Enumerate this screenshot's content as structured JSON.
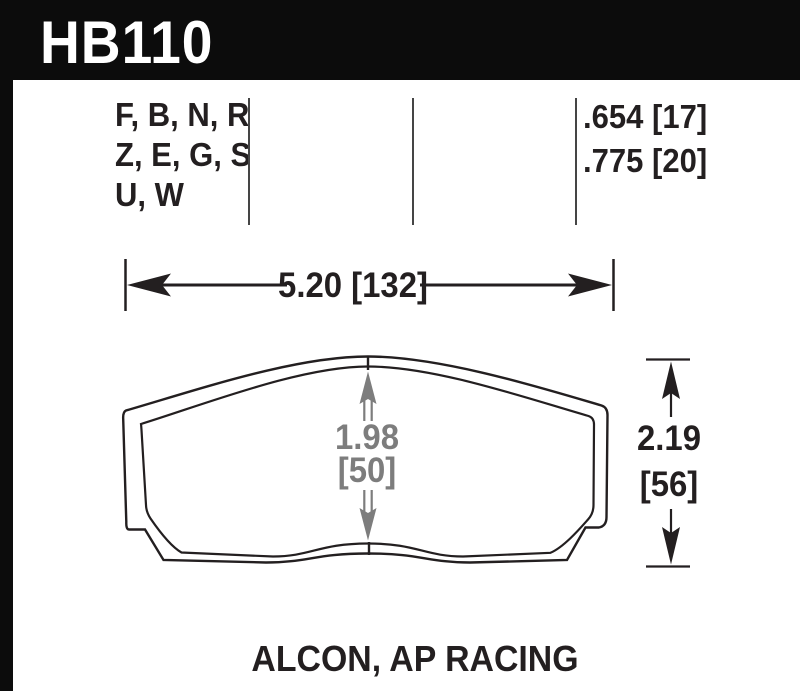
{
  "header": {
    "part_number": "HB110"
  },
  "spec_row": {
    "compound_lines": [
      "F, B, N, R",
      "Z, E, G, S",
      "U, W"
    ],
    "thickness_lines": [
      ".654 [17]",
      ".775 [20]"
    ]
  },
  "dimensions": {
    "width_label": "5.20 [132]",
    "center_height_in": "1.98",
    "center_height_mm": "[50]",
    "overall_height_in": "2.19",
    "overall_height_mm": "[56]"
  },
  "caption": "ALCON, AP RACING",
  "colors": {
    "ink": "#231f20",
    "dim_gray": "#7d7d7d",
    "header_bg": "#0c0c0c"
  }
}
